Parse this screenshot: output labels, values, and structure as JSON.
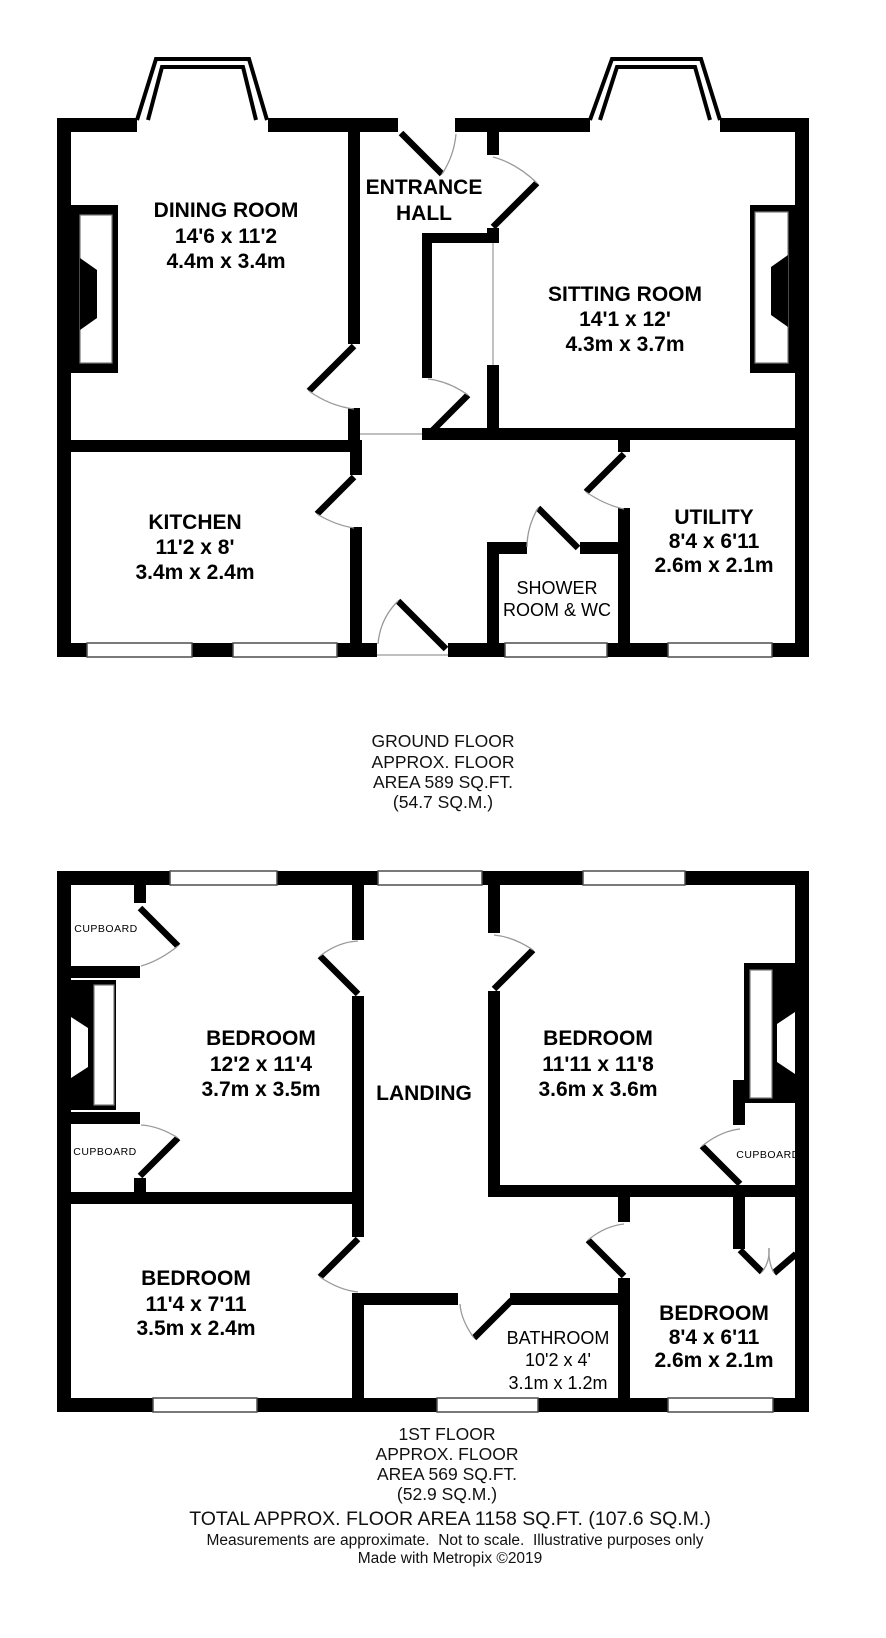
{
  "ground_floor": {
    "rooms": {
      "dining": {
        "name": "DINING ROOM",
        "size_ft": "14'6 x 11'2",
        "size_m": "4.4m x 3.4m"
      },
      "entrance_hall": {
        "line1": "ENTRANCE",
        "line2": "HALL"
      },
      "sitting": {
        "name": "SITTING ROOM",
        "size_ft": "14'1 x 12'",
        "size_m": "4.3m x 3.7m"
      },
      "kitchen": {
        "name": "KITCHEN",
        "size_ft": "11'2 x 8'",
        "size_m": "3.4m x 2.4m"
      },
      "utility": {
        "name": "UTILITY",
        "size_ft": "8'4 x 6'11",
        "size_m": "2.6m x 2.1m"
      },
      "shower": {
        "line1": "SHOWER",
        "line2": "ROOM & WC"
      }
    },
    "caption": {
      "line1": "GROUND FLOOR",
      "line2": "APPROX. FLOOR",
      "line3": "AREA 589 SQ.FT.",
      "line4": "(54.7 SQ.M.)"
    }
  },
  "first_floor": {
    "rooms": {
      "bedroom1": {
        "name": "BEDROOM",
        "size_ft": "12'2 x 11'4",
        "size_m": "3.7m x 3.5m"
      },
      "landing": {
        "name": "LANDING"
      },
      "bedroom2": {
        "name": "BEDROOM",
        "size_ft": "11'11 x 11'8",
        "size_m": "3.6m x 3.6m"
      },
      "bedroom3": {
        "name": "BEDROOM",
        "size_ft": "11'4 x 7'11",
        "size_m": "3.5m x 2.4m"
      },
      "bathroom": {
        "name": "BATHROOM",
        "size_ft": "10'2 x 4'",
        "size_m": "3.1m x 1.2m"
      },
      "bedroom4": {
        "name": "BEDROOM",
        "size_ft": "8'4 x 6'11",
        "size_m": "2.6m x 2.1m"
      },
      "cupboard_top_left": {
        "name": "CUPBOARD"
      },
      "cupboard_mid_left": {
        "name": "CUPBOARD"
      },
      "cupboard_right": {
        "name": "CUPBOARD"
      }
    },
    "caption": {
      "line1": "1ST FLOOR",
      "line2": "APPROX. FLOOR",
      "line3": "AREA 569 SQ.FT.",
      "line4": "(52.9 SQ.M.)"
    }
  },
  "footer": {
    "total": "TOTAL APPROX. FLOOR AREA 1158 SQ.FT. (107.6 SQ.M.)",
    "disclaimer": "Measurements are approximate.  Not to scale.  Illustrative purposes only",
    "credit": "Made with Metropix ©2019"
  },
  "colors": {
    "wall": "#000000",
    "background": "#ffffff",
    "door_arc": "#999999",
    "window_outline": "#4d4d4d"
  }
}
